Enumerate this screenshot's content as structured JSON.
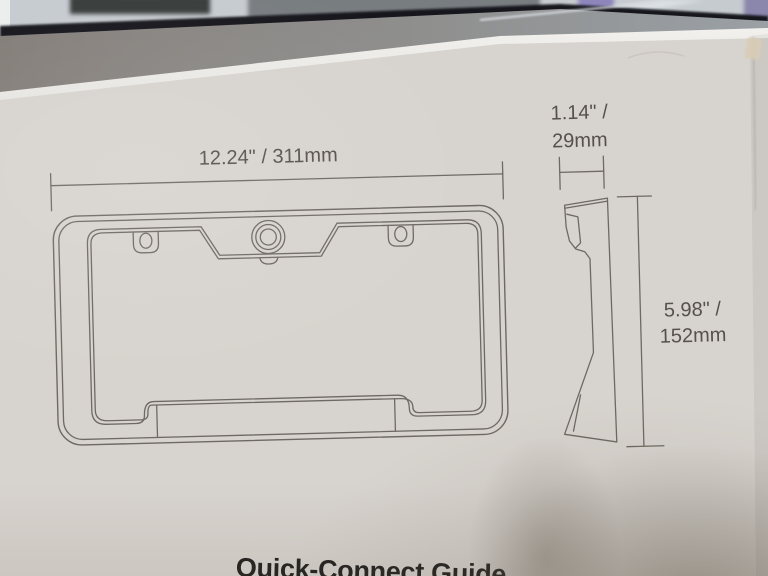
{
  "labels": {
    "width": "12.24\" / 311mm",
    "depth_line1": "1.14\" /",
    "depth_line2": "29mm",
    "height_line1": "5.98\" /",
    "height_line2": "152mm",
    "title": "Quick-Connect Guide"
  },
  "colors": {
    "box_face": "#d7d3ce",
    "line_color": "#6e6963",
    "dim_text": "#56514c",
    "title_text": "#21201e",
    "lid_edge": "#eceae6",
    "wall_purple": "#8e85bb",
    "shelf_dark": "#17191b"
  }
}
